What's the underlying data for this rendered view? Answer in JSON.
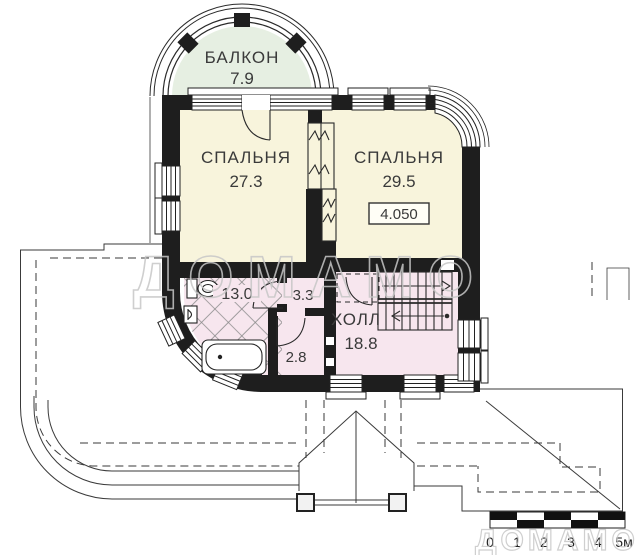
{
  "plan": {
    "type": "floor-plan",
    "floor_level_mark": "4.050",
    "rooms": {
      "balcony": {
        "label": "БАЛКОН",
        "area": "7.9"
      },
      "bedroom1": {
        "label": "СПАЛЬНЯ",
        "area": "27.3"
      },
      "bedroom2": {
        "label": "СПАЛЬНЯ",
        "area": "29.5",
        "level_mark": "4.050"
      },
      "bathroom": {
        "area": "13.0"
      },
      "wc": {
        "area": "3.3"
      },
      "closet": {
        "area": "2.8"
      },
      "hall": {
        "label": "ХОЛЛ",
        "area": "18.8"
      }
    },
    "scale_bar": {
      "labels": [
        "0",
        "1",
        "2",
        "3",
        "4",
        "5м"
      ]
    },
    "watermark": {
      "text": "ДОМАМО"
    },
    "colors": {
      "walls": "#1e1e1e",
      "bedroom_fill": "#f8f4dc",
      "balcony_fill": "#e6efe2",
      "hall_fill": "#f7e6ee",
      "watermark": "#c7c7c7",
      "lines": "#333333"
    }
  }
}
